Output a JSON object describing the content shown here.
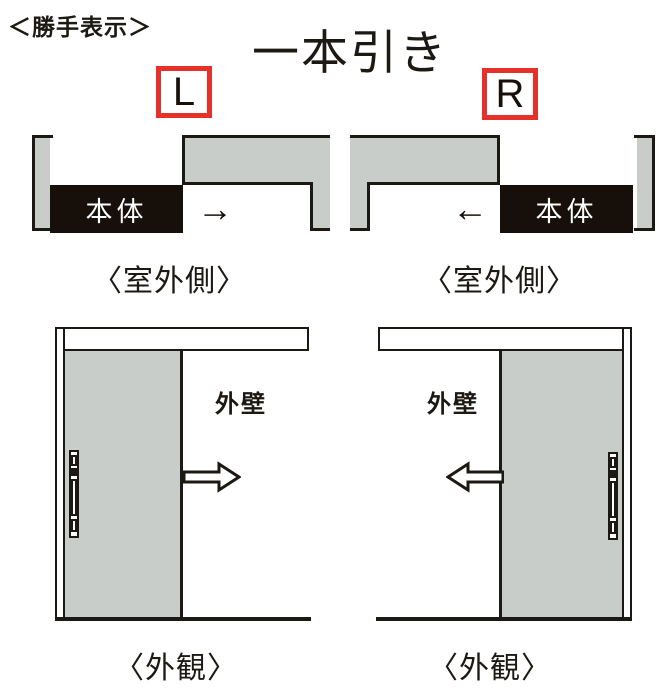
{
  "header": {
    "note": "＜勝手表示＞",
    "title": "一本引き"
  },
  "colors": {
    "accent_red": "#e6312b",
    "wall_gray": "#c9cdca",
    "line_black": "#1c1813",
    "panel_black": "#17100a"
  },
  "variants": [
    {
      "handing": "L",
      "plan": {
        "panel_label": "本体",
        "direction_arrow": "→",
        "caption": "〈室外側〉"
      },
      "elevation": {
        "wall_label": "外壁",
        "caption": "〈外観〉",
        "arrow_direction": "right"
      }
    },
    {
      "handing": "R",
      "plan": {
        "panel_label": "本体",
        "direction_arrow": "←",
        "caption": "〈室外側〉"
      },
      "elevation": {
        "wall_label": "外壁",
        "caption": "〈外観〉",
        "arrow_direction": "left"
      }
    }
  ]
}
